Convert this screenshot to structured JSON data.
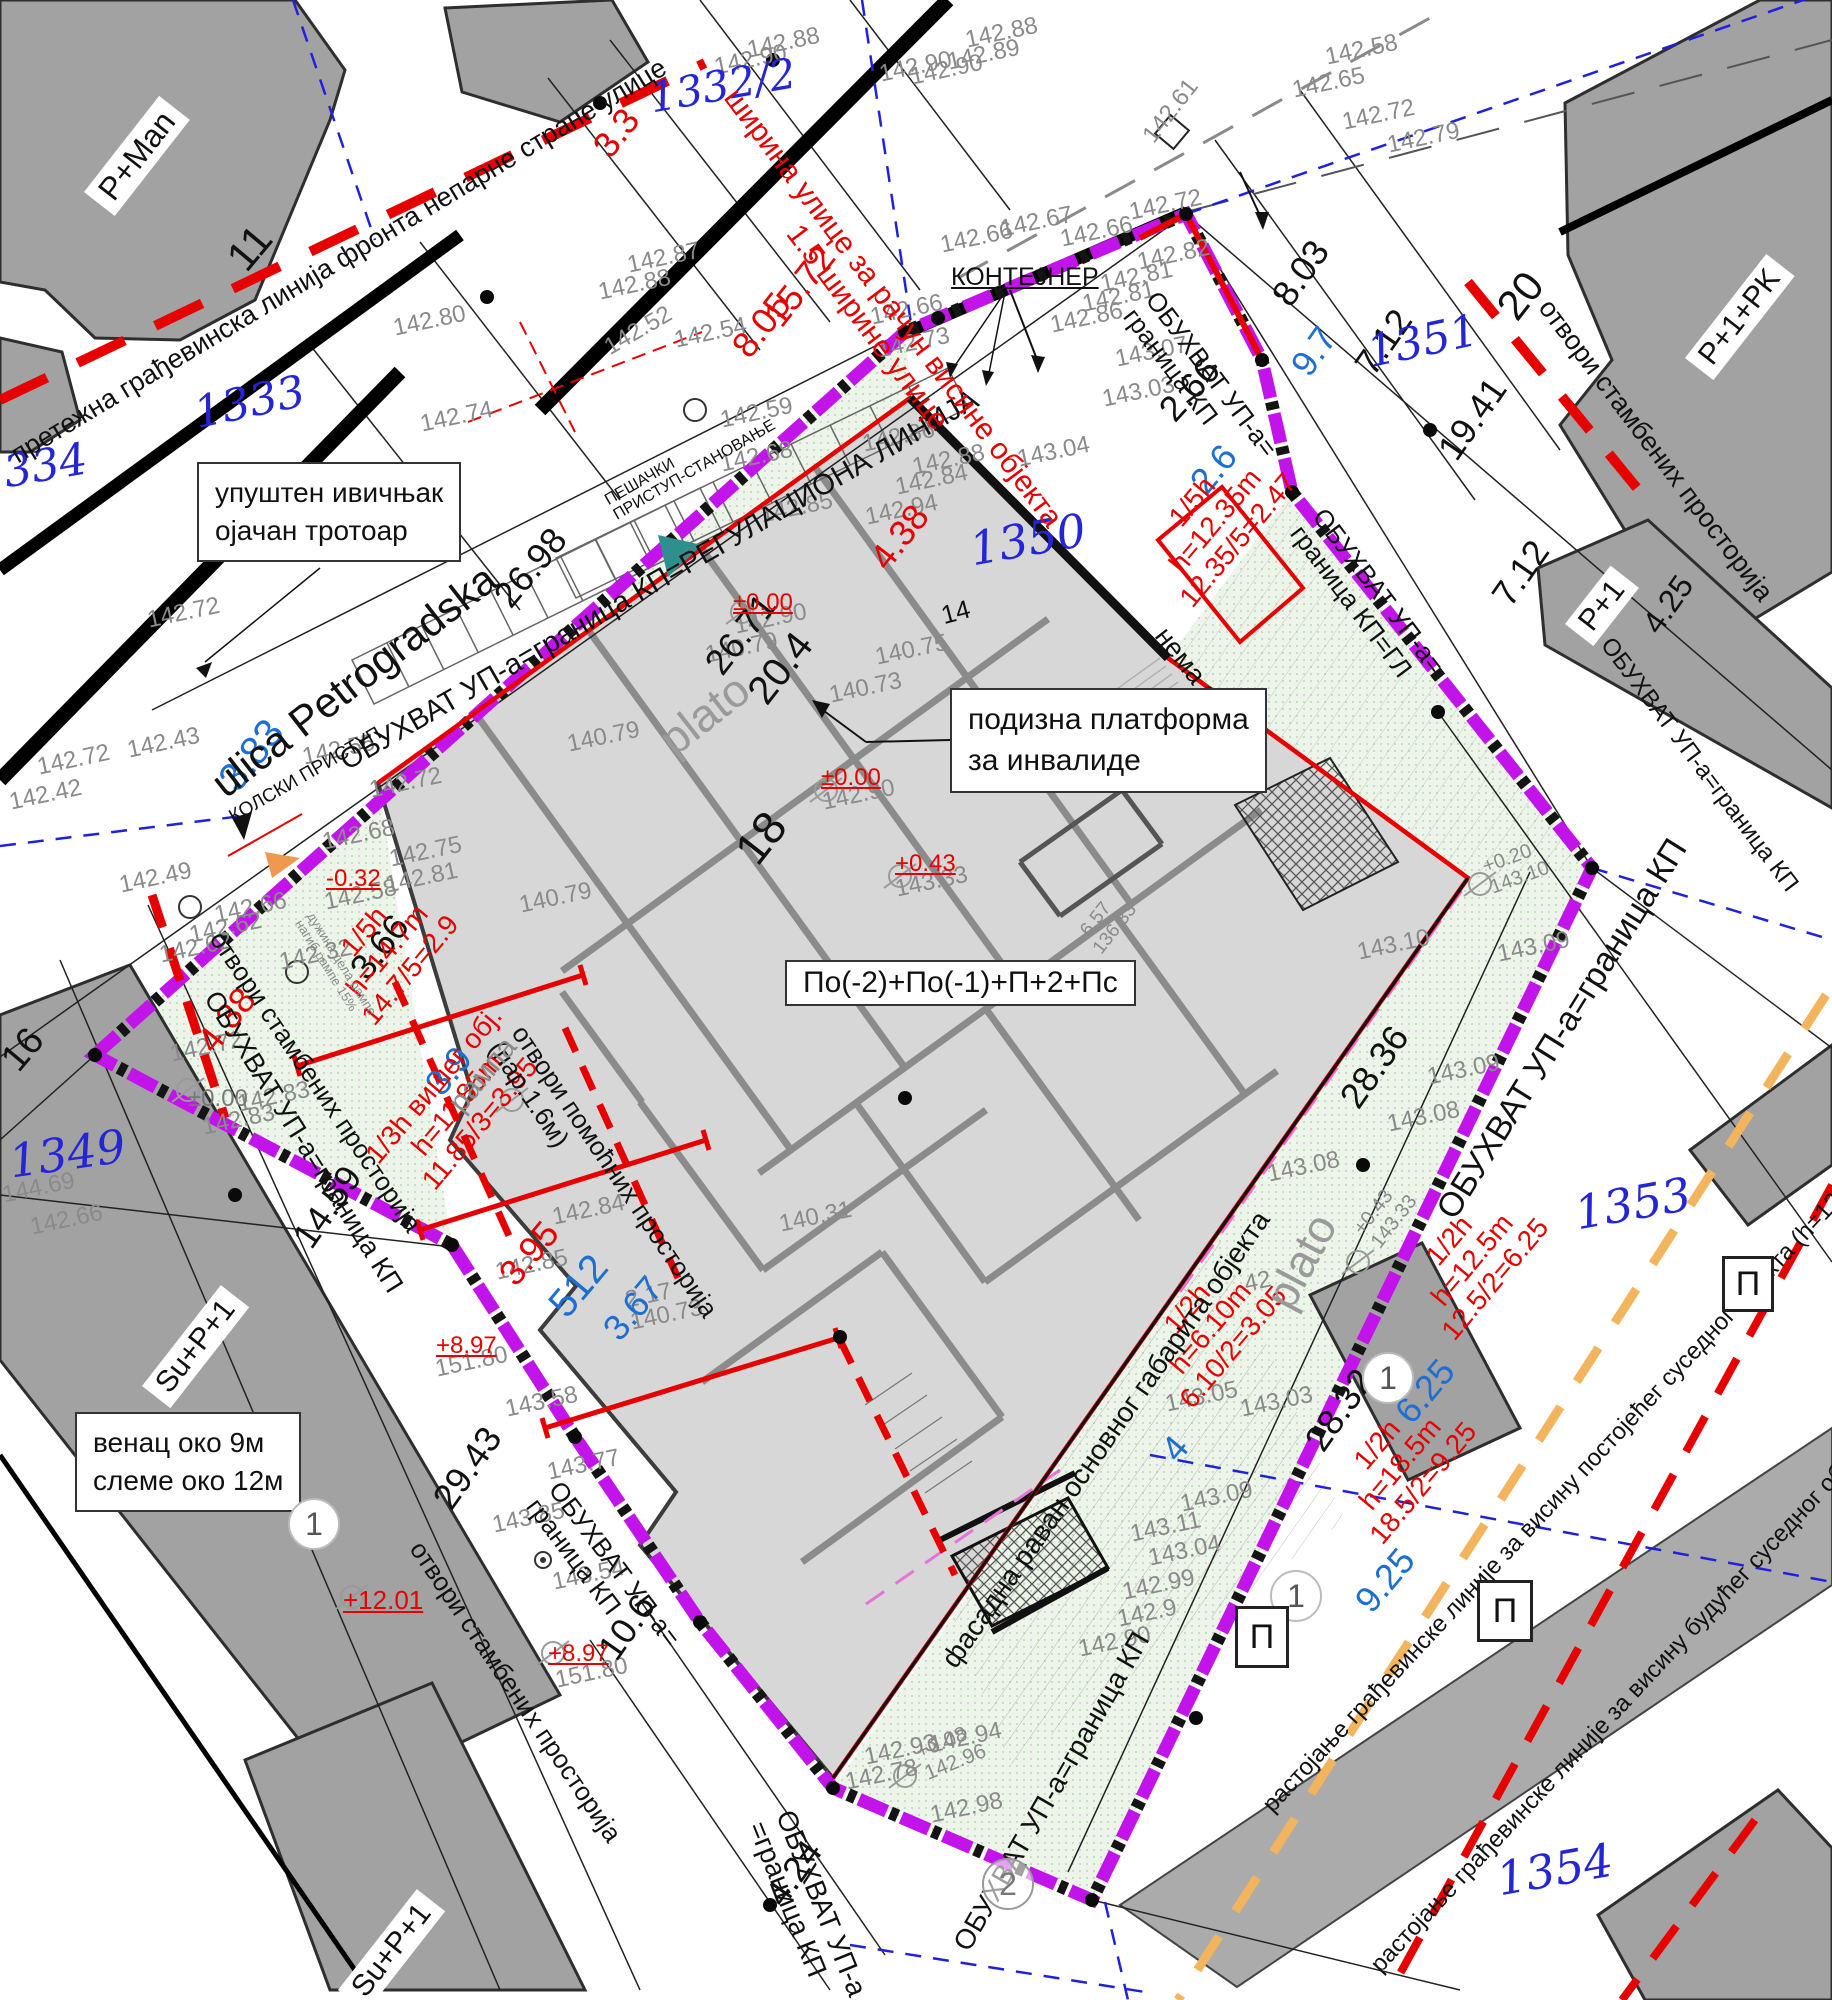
{
  "parcels": {
    "p1332": "1332/2",
    "p1333": "1333",
    "p1334": "334",
    "p1349": "1349",
    "p1350": "1350",
    "p1351": "1351",
    "p1353": "1353",
    "p1354": "1354"
  },
  "house_numbers": {
    "n11": "11",
    "n14": "14",
    "n16": "16",
    "n18": "18",
    "n20": "20"
  },
  "buildings": {
    "pman": "P+Man",
    "p1pk": "P+1+PK",
    "p1": "P+1",
    "sup1a": "Su+P+1",
    "sup1b": "Su+P+1",
    "main_floors": "По(-2)+По(-1)+П+2+Пс"
  },
  "street_name": "ulica Petrogradska",
  "boxes": {
    "curb": "упуштен ивичњак\nојачан тротоар",
    "platform": "подизна платформа\nза инвалиде",
    "venac": "венац око 9м\nслеме око 12м",
    "kontejner": "КОНТЕЈНЕР"
  },
  "access": {
    "pedestrian": "ПЕШАЧКИ\nПРИСТУП-СТАНОВАЊЕ",
    "vehicle": "КОЛСКИ ПРИСТУП",
    "ramp": "дужина дела рампе\nнагиб рампе 15%",
    "rampa": "рампа",
    "plato": "plato"
  },
  "boundary": {
    "regulation": "ОБУХВАТ УП-а=граница КП=РЕГУЛАЦИОНА ЛИНИЈА",
    "top_right": "ОБУХВАТ УП-а=\nграница КП",
    "gl": "ОБУХВАТ УП-а=\nграница КП=ГЛ",
    "right": "ОБУХВАТ УП-а=граница КП",
    "se": "ОБУХВАТ УП-а=граница КП",
    "left": "ОБУХВАТ УП-а=граница КП",
    "left_lower": "ОБУХВАТ УП-а=\nграница КП",
    "bottom": "ОБУХВАТ УП-а\n=граница КП",
    "bottom_right": "ОБУХВАТ УП-а=граница КП"
  },
  "openings": {
    "residential": "отвори стамбених просторија",
    "residential_left_upper": "отвори стамбених просторија",
    "residential_left_lower": "отвори стамбених просторија",
    "auxiliary": "отвори помоћних просторија\n(пар.1.6м)",
    "none": "нема отвора",
    "facade": "фасадна раван основног габарита објекта"
  },
  "regulation_lines": {
    "front": "претежна грађевинска линија фронта непарне стране улице",
    "street_width": "ширина улице за рачун висине објекта\n1.5 ширине улице",
    "dist_existing": "растојање грађевинске линије за висину постојећег суседног објекта (h=12.5m)",
    "dist_future": "растојање грађевинске линије за висину будућег суседног објекта (h=",
    "f1": "1/5h\nh=12.35m\n12.35/5=2.47",
    "f2": "1/5h\nh=14.7m\n14.7/5=2.9",
    "f3": "1/3h вишег обј.\nh=11.85m\n11.85/3=3.95",
    "f4": "1/2h\nh=12.5m\n12.5/2=6.25",
    "f5": "1/2h\nh=18.5m\n18.5/2=9.25",
    "f6": "1/2h\nh=6.10m\n6.10/2=3.05"
  },
  "dims": {
    "black": [
      "26.98",
      "26.71",
      "20.4",
      "2.66",
      "8.03",
      "7.12",
      "19.41",
      "7.12",
      "4.25",
      "3.66",
      "14.59",
      "29.43",
      "10.6",
      "4.24",
      "28.36",
      "28.32"
    ],
    "blue": [
      "3.83",
      "2.6",
      "9.7",
      "3.9",
      "512",
      "3.67",
      "6.25",
      "9.25",
      "4"
    ],
    "red": [
      "3.3",
      "8.05",
      "15.72",
      "4.38",
      "4.38",
      "3.95"
    ]
  },
  "levels": {
    "l1": "±0.00",
    "l2": "±0.00",
    "l3": "+0.43",
    "l4": "-0.32",
    "l5": "+8.97",
    "l6": "+8.97",
    "l7": "+12.01",
    "l8": "±0.00",
    "l9": "+0.20\n143.10",
    "l10": "-6.57\n136.33",
    "l11": "+0.43\n143.33",
    "l12": "+0.08\n142.96"
  },
  "elev": [
    "142.88",
    "142.90",
    "142.90",
    "142.88",
    "142.89",
    "142.90",
    "142.58",
    "142.65",
    "142.72",
    "142.79",
    "142.61",
    "142.72",
    "142.67",
    "142.66",
    "142.66",
    "142.82",
    "142.81",
    "142.81",
    "142.86",
    "143.07",
    "143.03",
    "142.74",
    "142.80",
    "142.87",
    "142.88",
    "142.52",
    "142.54",
    "142.59",
    "142.68",
    "142.66",
    "142.73",
    "142.86",
    "142.88",
    "142.84",
    "142.94",
    "142.85",
    "143.04",
    "140.79",
    "140.79",
    "140.79",
    "140.75",
    "140.73",
    "142.90",
    "142.90",
    "143.33",
    "142.55",
    "142.72",
    "142.72",
    "142.72",
    "142.43",
    "142.42",
    "142.49",
    "142.66",
    "142.62",
    "142.62",
    "142.32",
    "142.68",
    "142.75",
    "142.81",
    "142.58",
    "144.69",
    "142.66",
    "142.72",
    "142.83",
    "142.83",
    "151.80",
    "151.80",
    "143.58",
    "143.77",
    "143.85",
    "143.54",
    "140.31",
    "142.84",
    "142.85",
    "2.17",
    "140.73",
    "143.10",
    "143.09",
    "143.09",
    "143.08",
    "143.08",
    "42",
    "143.03",
    "143.05",
    "143.09",
    "143.11",
    "143.04",
    "142.99",
    "142.9",
    "142.90",
    "142.93",
    "142.94",
    "142.78",
    "142.98"
  ],
  "markers": {
    "one": "1",
    "two": "2",
    "p": "П"
  }
}
